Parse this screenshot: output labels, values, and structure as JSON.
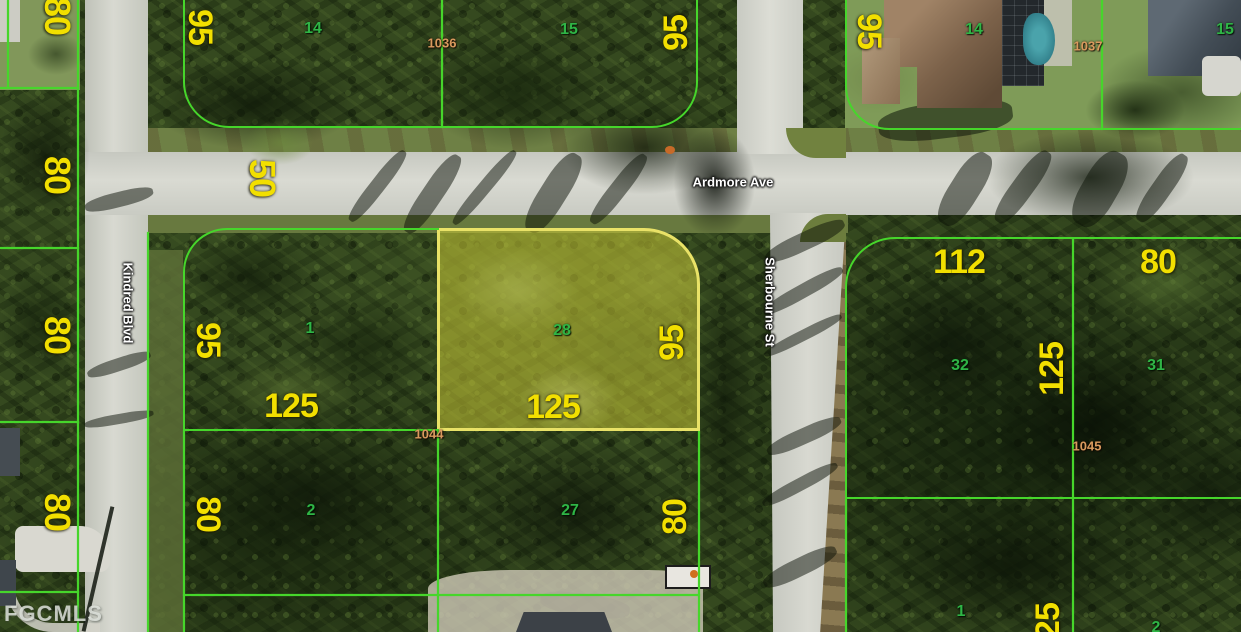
{
  "watermark": "FGCMLS",
  "streets": {
    "ardmore": {
      "name": "Ardmore Ave",
      "width_label": "50"
    },
    "kindred": {
      "name": "Kindred Blvd"
    },
    "sherbourne": {
      "name": "Sherbourne St"
    }
  },
  "west_parcels": {
    "dims": [
      "80",
      "80",
      "80",
      "80"
    ]
  },
  "north_left_block": {
    "west_dim": "95",
    "lot14": {
      "number": "14"
    },
    "block_id": "1036",
    "lot15": {
      "number": "15"
    },
    "east_dim": "95"
  },
  "north_right_block": {
    "west_dim": "95",
    "lot14": {
      "number": "14"
    },
    "block_id": "1037",
    "lot15": {
      "number": "15"
    }
  },
  "center_block": {
    "block_id": "1044",
    "lot1": {
      "number": "1",
      "west_dim": "95",
      "south_dim": "125"
    },
    "lot28": {
      "number": "28",
      "south_dim": "125",
      "east_dim": "95",
      "highlighted": true
    },
    "lot2": {
      "number": "2",
      "west_dim": "80"
    },
    "lot27": {
      "number": "27",
      "east_dim": "80"
    }
  },
  "east_block": {
    "block_id": "1045",
    "lot32": {
      "number": "32",
      "north_dim": "112"
    },
    "lot31": {
      "number": "31",
      "north_dim": "80",
      "west_dim": "125"
    },
    "lot1": {
      "number": "1"
    },
    "lot2": {
      "number": "2"
    },
    "south_dim": "125"
  },
  "colors": {
    "parcel_line": "#46d62b",
    "highlight_border": "#e9e267",
    "highlight_fill": "rgba(210,206,54,0.5)",
    "dimension_text": "#f2df00",
    "lot_number_text": "#2fb546",
    "block_id_text": "#d99a5e",
    "street_text": "#ffffff"
  }
}
